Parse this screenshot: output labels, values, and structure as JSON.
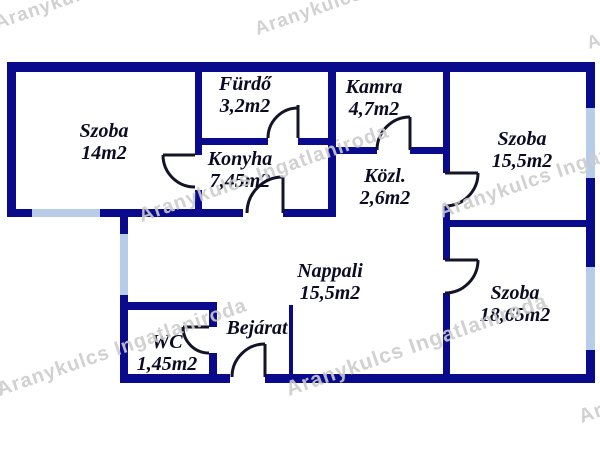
{
  "watermark": {
    "text": "Aranykulcs Ingatlaniroda"
  },
  "colors": {
    "wall": "#0a0a8c",
    "window": "#b7cce9",
    "door_line": "#141428",
    "label": "#0b0b24",
    "watermark": "#cdcdcd",
    "background": "#ffffff"
  },
  "rooms": [
    {
      "name": "Szoba",
      "area": "14m2"
    },
    {
      "name": "Fürdő",
      "area": "3,2m2"
    },
    {
      "name": "Kamra",
      "area": "4,7m2"
    },
    {
      "name": "Szoba",
      "area": "15,5m2"
    },
    {
      "name": "Konyha",
      "area": "7,45m2"
    },
    {
      "name": "Közl.",
      "area": "2,6m2"
    },
    {
      "name": "Nappali",
      "area": "15,5m2"
    },
    {
      "name": "Szoba",
      "area": "18,65m2"
    },
    {
      "name": "WC",
      "area": "1,45m2"
    },
    {
      "name": "Bejárat"
    }
  ]
}
